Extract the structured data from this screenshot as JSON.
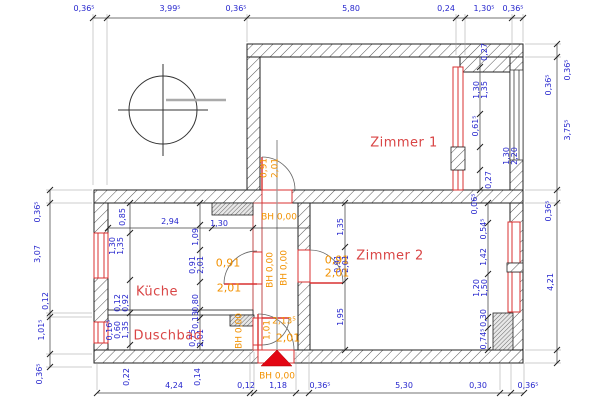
{
  "drawing": {
    "type": "architectural-floor-plan",
    "colors": {
      "dimension": "#2525cd",
      "level_mark": "#f29100",
      "room_label": "#d94545",
      "opening": "#d93030",
      "entrance_arrow": "#e30613",
      "wall_line": "#222222"
    },
    "rooms": [
      {
        "t": "Zimmer 1",
        "x": 404,
        "y": 143
      },
      {
        "t": "Zimmer 2",
        "x": 390,
        "y": 256
      },
      {
        "t": "Küche",
        "x": 157,
        "y": 292
      },
      {
        "t": "Duschbad",
        "x": 168,
        "y": 336
      }
    ],
    "labels": [
      {
        "t": "0,36⁵",
        "x": 84,
        "y": 9
      },
      {
        "t": "3,99⁵",
        "x": 170,
        "y": 9
      },
      {
        "t": "0,36⁵",
        "x": 236,
        "y": 9
      },
      {
        "t": "5,80",
        "x": 351,
        "y": 9
      },
      {
        "t": "0,24",
        "x": 446,
        "y": 9
      },
      {
        "t": "1,30⁵",
        "x": 484,
        "y": 9
      },
      {
        "t": "0,36⁵",
        "x": 513,
        "y": 9
      },
      {
        "t": "4,24",
        "x": 174,
        "y": 386
      },
      {
        "t": "0,12",
        "x": 246,
        "y": 386
      },
      {
        "t": "1,18",
        "x": 278,
        "y": 386
      },
      {
        "t": "0,36⁵",
        "x": 320,
        "y": 386
      },
      {
        "t": "5,30",
        "x": 404,
        "y": 386
      },
      {
        "t": "0,30",
        "x": 478,
        "y": 386
      },
      {
        "t": "0,36⁵",
        "x": 528,
        "y": 386
      },
      {
        "t": "0,36⁵",
        "x": 38,
        "y": 212,
        "r": 1
      },
      {
        "t": "3,07",
        "x": 38,
        "y": 254,
        "r": 1
      },
      {
        "t": "0,12",
        "x": 46,
        "y": 301,
        "r": 1
      },
      {
        "t": "1,01⁵",
        "x": 42,
        "y": 330,
        "r": 1
      },
      {
        "t": "0,36⁵",
        "x": 40,
        "y": 374,
        "r": 1
      },
      {
        "t": "0,36⁵",
        "x": 568,
        "y": 70,
        "r": 1
      },
      {
        "t": "0,36⁵",
        "x": 549,
        "y": 85,
        "r": 1
      },
      {
        "t": "3,75⁵",
        "x": 568,
        "y": 130,
        "r": 1
      },
      {
        "t": "0,36⁵",
        "x": 549,
        "y": 211,
        "r": 1
      },
      {
        "t": "4,21",
        "x": 551,
        "y": 282,
        "r": 1
      },
      {
        "t": "0,27",
        "x": 485,
        "y": 52,
        "r": 1
      },
      {
        "t": "1,30",
        "x": 477,
        "y": 90,
        "r": 1
      },
      {
        "t": "1,35",
        "x": 485,
        "y": 90,
        "r": 1
      },
      {
        "t": "0,61⁵",
        "x": 476,
        "y": 126,
        "r": 1
      },
      {
        "t": "1,30",
        "x": 507,
        "y": 156,
        "r": 1
      },
      {
        "t": "2,20",
        "x": 515,
        "y": 156,
        "r": 1
      },
      {
        "t": "0,27",
        "x": 489,
        "y": 180,
        "r": 1
      },
      {
        "t": "0,06⁵",
        "x": 475,
        "y": 204,
        "r": 1
      },
      {
        "t": "0,54⁵",
        "x": 484,
        "y": 229,
        "r": 1
      },
      {
        "t": "1,42",
        "x": 484,
        "y": 257,
        "r": 1
      },
      {
        "t": "1,20",
        "x": 477,
        "y": 288,
        "r": 1
      },
      {
        "t": "1,50",
        "x": 485,
        "y": 288,
        "r": 1
      },
      {
        "t": "0,30",
        "x": 484,
        "y": 318,
        "r": 1
      },
      {
        "t": "0,74⁵",
        "x": 484,
        "y": 339,
        "r": 1
      },
      {
        "t": "1,35",
        "x": 341,
        "y": 227,
        "r": 1
      },
      {
        "t": "0,91",
        "x": 338,
        "y": 264,
        "r": 1
      },
      {
        "t": "2,01",
        "x": 346,
        "y": 264,
        "r": 1
      },
      {
        "t": "1,95",
        "x": 341,
        "y": 317,
        "r": 1
      },
      {
        "t": "0,85",
        "x": 123,
        "y": 217,
        "r": 1
      },
      {
        "t": "2,94",
        "x": 170,
        "y": 222
      },
      {
        "t": "1,30",
        "x": 219,
        "y": 224
      },
      {
        "t": "1,09",
        "x": 196,
        "y": 237,
        "r": 1
      },
      {
        "t": "1,30",
        "x": 113,
        "y": 246,
        "r": 1
      },
      {
        "t": "1,35",
        "x": 121,
        "y": 246,
        "r": 1
      },
      {
        "t": "0,91",
        "x": 193,
        "y": 265,
        "r": 1
      },
      {
        "t": "2,01",
        "x": 201,
        "y": 265,
        "r": 1
      },
      {
        "t": "0,12",
        "x": 118,
        "y": 303,
        "r": 1
      },
      {
        "t": "0,92",
        "x": 126,
        "y": 303,
        "r": 1
      },
      {
        "t": "0,80",
        "x": 196,
        "y": 303,
        "r": 1
      },
      {
        "t": "0,16⁵",
        "x": 110,
        "y": 330,
        "r": 1
      },
      {
        "t": "0,60",
        "x": 118,
        "y": 330,
        "r": 1
      },
      {
        "t": "1,35",
        "x": 126,
        "y": 330,
        "r": 1
      },
      {
        "t": "0,13",
        "x": 196,
        "y": 320,
        "r": 1
      },
      {
        "t": "0,75",
        "x": 193,
        "y": 338,
        "r": 1
      },
      {
        "t": "2,01",
        "x": 201,
        "y": 338,
        "r": 1
      },
      {
        "t": "0,22",
        "x": 127,
        "y": 377,
        "r": 1
      },
      {
        "t": "0,14",
        "x": 198,
        "y": 377,
        "r": 1
      },
      {
        "t": "BH 0,00",
        "x": 279,
        "y": 218,
        "c": "o"
      },
      {
        "t": "BH 0,00",
        "x": 271,
        "y": 270,
        "r": 1,
        "c": "o"
      },
      {
        "t": "BH 0,00",
        "x": 285,
        "y": 268,
        "r": 1,
        "c": "o"
      },
      {
        "t": "BH 0,00",
        "x": 240,
        "y": 331,
        "r": 1,
        "c": "o"
      },
      {
        "t": "BH 0,00",
        "x": 277,
        "y": 377,
        "c": "o"
      },
      {
        "t": "0,91",
        "x": 265,
        "y": 168,
        "r": 1,
        "c": "o"
      },
      {
        "t": "2,01",
        "x": 276,
        "y": 168,
        "r": 1,
        "c": "o"
      },
      {
        "t": "0,91",
        "x": 228,
        "y": 263,
        "c": "o",
        "fs": 11
      },
      {
        "t": "2,01",
        "x": 229,
        "y": 288,
        "c": "o",
        "fs": 11
      },
      {
        "t": "0,91",
        "x": 337,
        "y": 260,
        "c": "o",
        "fs": 11
      },
      {
        "t": "2,01",
        "x": 337,
        "y": 273,
        "c": "o",
        "fs": 11
      },
      {
        "t": "1,01",
        "x": 268,
        "y": 330,
        "r": 1,
        "c": "o"
      },
      {
        "t": "2,13⁵",
        "x": 284,
        "y": 322,
        "c": "o"
      },
      {
        "t": "2,01",
        "x": 288,
        "y": 338,
        "c": "o",
        "fs": 11
      }
    ]
  }
}
